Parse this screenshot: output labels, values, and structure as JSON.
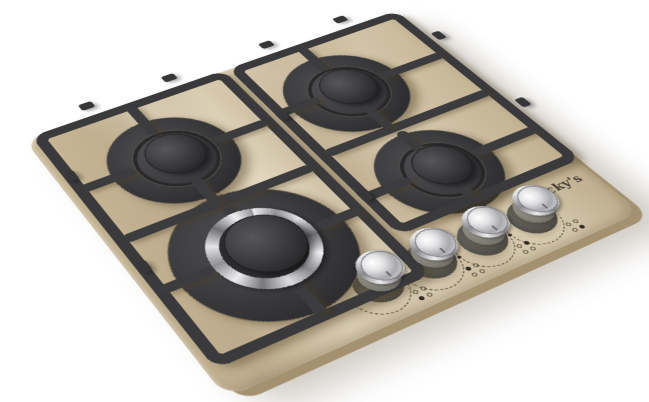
{
  "background_color": "#ffffff",
  "hob": {
    "brand": "Jacky's",
    "surface_color": "#c6b596",
    "surface_edge_color": "#a3916f",
    "grate_color": "#3a3a3c",
    "chrome_color": "#d9d9dc",
    "knob_body_color": "#807e74",
    "marking_color": "#5a5242",
    "burner_count": 4,
    "knob_count": 4,
    "burners": [
      {
        "name": "back-left-burner",
        "size": "medium"
      },
      {
        "name": "back-right-burner",
        "size": "medium"
      },
      {
        "name": "front-right-burner",
        "size": "medium"
      },
      {
        "name": "front-left-burner",
        "size": "large-triple-crown-chrome"
      }
    ],
    "knobs": [
      {
        "name": "knob-1",
        "indicator": "burner-position-front-left"
      },
      {
        "name": "knob-2",
        "indicator": "burner-position-back-left"
      },
      {
        "name": "knob-3",
        "indicator": "burner-position-back-right"
      },
      {
        "name": "knob-4",
        "indicator": "burner-position-front-right"
      }
    ]
  }
}
